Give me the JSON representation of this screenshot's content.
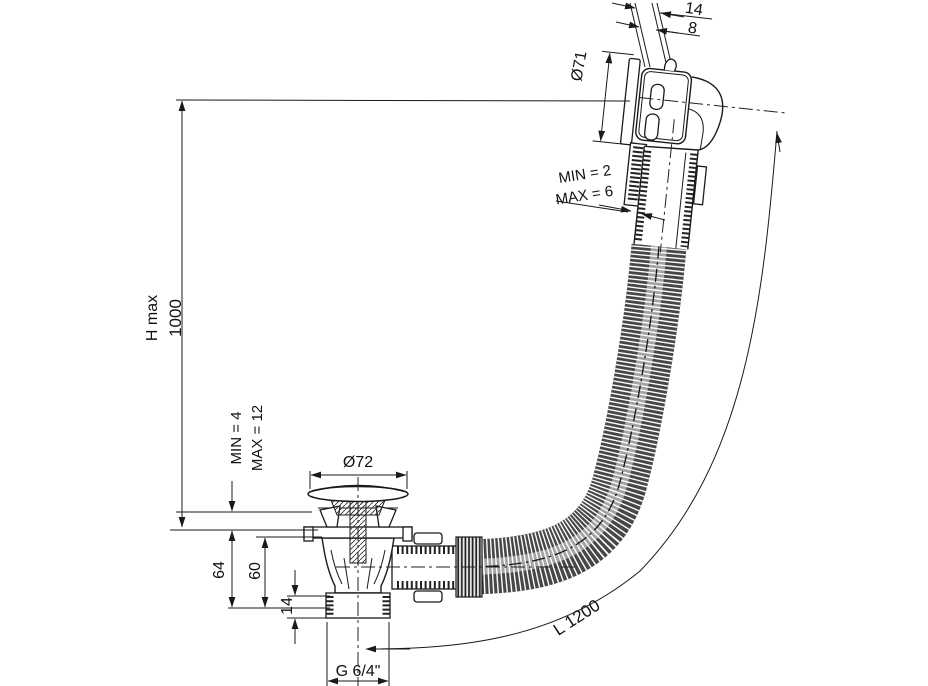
{
  "drawing": {
    "title_hint": "bath waste and overflow set dimension drawing",
    "colors": {
      "background": "#ffffff",
      "line": "#1a1a1a",
      "hose_dark": "#474747"
    },
    "labels": {
      "rim": {
        "total_width": "14",
        "wall_thickness": "8"
      },
      "overflow": {
        "diameter": "Ø71",
        "clamp_min": "MIN = 2",
        "clamp_max": "MAX = 6"
      },
      "height": {
        "label": "H max",
        "value": "1000"
      },
      "floor_clamp": {
        "min": "MIN = 4",
        "max": "MAX = 12"
      },
      "waste": {
        "diameter": "Ø72",
        "height_total": "64",
        "height_body": "60",
        "thread_height": "14",
        "thread_size": "G 6/4\""
      },
      "hose": {
        "length": "L 1200"
      }
    }
  }
}
